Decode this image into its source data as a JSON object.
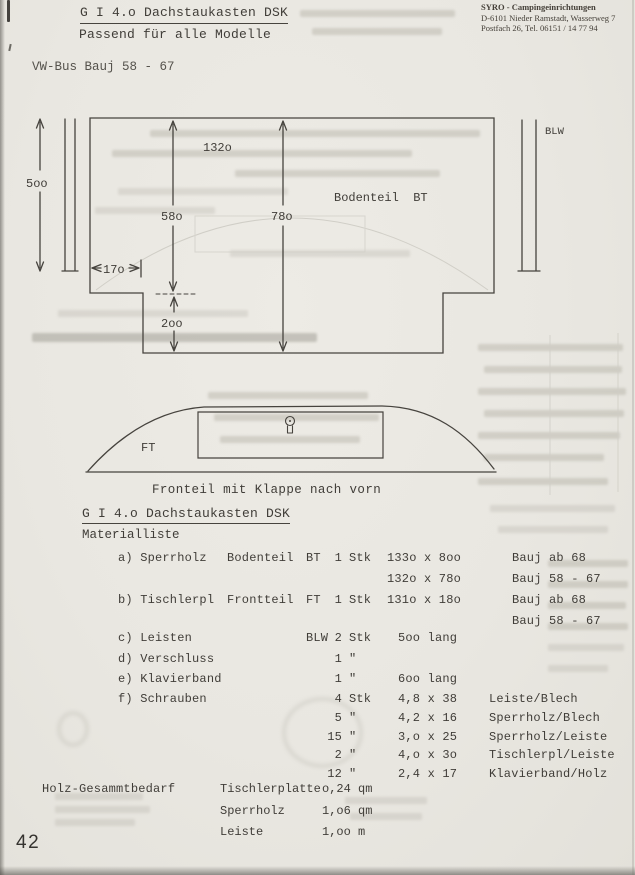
{
  "stamp": {
    "line1": "SYRO - Campingeinrichtungen",
    "line2": "D-6101 Nieder Ramstadt, Wasserweg 7",
    "line3": "Postfach 26, Tel. 06151 / 14 77 94"
  },
  "header": {
    "title": "G I 4.o Dachstaukasten DSK",
    "subtitle": "Passend für alle Modelle",
    "model": "VW-Bus Bauj 58 - 67"
  },
  "top_drawing": {
    "width_label": "132o",
    "height_label": "5oo",
    "side_label": "58o",
    "center_label": "78o",
    "offset_label": "17o",
    "notch_label": "2oo",
    "part_label": "Bodenteil  BT",
    "strip_label": "BLW"
  },
  "front_drawing": {
    "part_label": "FT",
    "caption": "Fronteil mit Klappe nach vorn"
  },
  "materials": {
    "heading": "G I 4.o Dachstaukasten DSK",
    "subheading": "Materialliste",
    "rows": [
      {
        "label": "a) Sperrholz",
        "name": "Bodenteil",
        "code": "BT",
        "qty": "1",
        "unit": "Stk",
        "size": "133o x 8oo",
        "note": "Bauj ab 68"
      },
      {
        "label": "",
        "name": "",
        "code": "",
        "qty": "",
        "unit": "",
        "size": "132o x 78o",
        "note": "Bauj 58 - 67"
      },
      {
        "label": "b) Tischlerpl",
        "name": "Frontteil",
        "code": "FT",
        "qty": "1",
        "unit": "Stk",
        "size": "131o x 18o",
        "note": "Bauj ab 68"
      },
      {
        "label": "",
        "name": "",
        "code": "",
        "qty": "",
        "unit": "",
        "size": "",
        "note": "Bauj 58 - 67"
      },
      {
        "label": "c) Leisten",
        "name": "",
        "code": "BLW",
        "qty": "2",
        "unit": "Stk",
        "size": "5oo lang",
        "note": ""
      },
      {
        "label": "d) Verschluss",
        "name": "",
        "code": "",
        "qty": "1",
        "unit": "\"",
        "size": "",
        "note": ""
      },
      {
        "label": "e) Klavierband",
        "name": "",
        "code": "",
        "qty": "1",
        "unit": "\"",
        "size": "6oo lang",
        "note": ""
      },
      {
        "label": "f) Schrauben",
        "name": "",
        "code": "",
        "qty": "4",
        "unit": "Stk",
        "size": "4,8 x 38",
        "note": "Leiste/Blech"
      },
      {
        "label": "",
        "name": "",
        "code": "",
        "qty": "5",
        "unit": "\"",
        "size": "4,2 x 16",
        "note": "Sperrholz/Blech"
      },
      {
        "label": "",
        "name": "",
        "code": "",
        "qty": "15",
        "unit": "\"",
        "size": "3,o x 25",
        "note": "Sperrholz/Leiste"
      },
      {
        "label": "",
        "name": "",
        "code": "",
        "qty": "2",
        "unit": "\"",
        "size": "4,o x 3o",
        "note": "Tischlerpl/Leiste"
      },
      {
        "label": "",
        "name": "",
        "code": "",
        "qty": "12",
        "unit": "\"",
        "size": "2,4 x 17",
        "note": "Klavierband/Holz"
      }
    ]
  },
  "totals": {
    "heading": "Holz-Gesammtbedarf",
    "rows": [
      {
        "name": "Tischlerplatte",
        "value": "o,24 qm"
      },
      {
        "name": "Sperrholz",
        "value": "1,o6 qm"
      },
      {
        "name": "Leiste",
        "value": "1,oo m"
      }
    ]
  },
  "page_number": "42"
}
